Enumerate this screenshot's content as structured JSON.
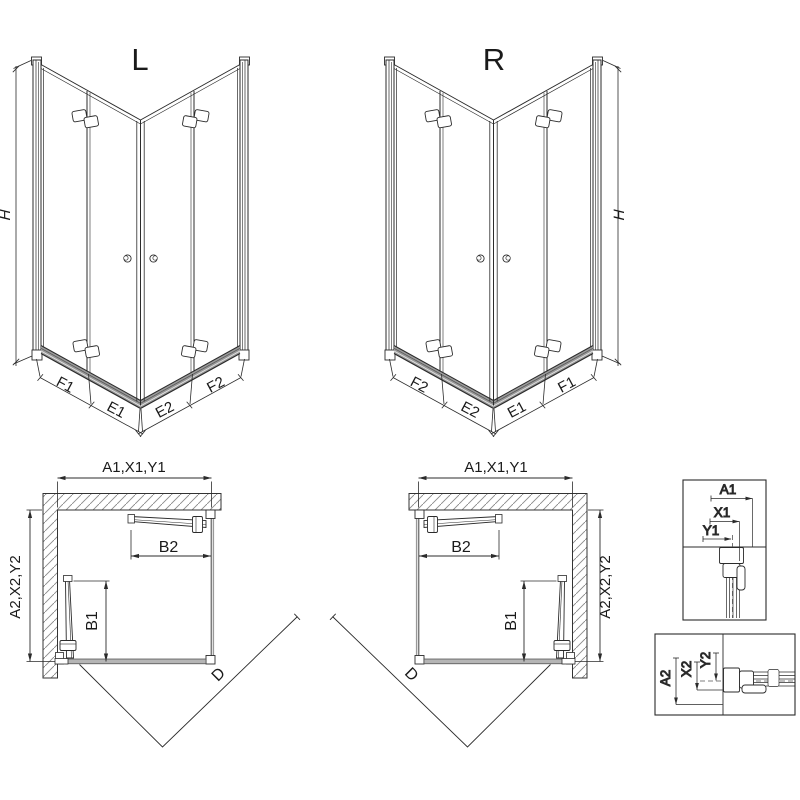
{
  "drawing": {
    "view_left": {
      "title": "L",
      "height_label": "H",
      "bottom_labels": [
        "F1",
        "E1",
        "E2",
        "F2"
      ]
    },
    "view_right": {
      "title": "R",
      "height_label": "H",
      "bottom_labels": [
        "F2",
        "E2",
        "E1",
        "F1"
      ]
    },
    "plan_left": {
      "width_label": "A1,X1,Y1",
      "depth_label": "A2,X2,Y2",
      "door_width_label": "B2",
      "door_depth_label": "B1",
      "diagonal_label": "D"
    },
    "plan_right": {
      "width_label": "A1,X1,Y1",
      "depth_label": "A2,X2,Y2",
      "door_width_label": "B2",
      "door_depth_label": "B1",
      "diagonal_label": "D"
    },
    "detail_top": {
      "labels": [
        "A1",
        "X1",
        "Y1"
      ]
    },
    "detail_bottom": {
      "labels": [
        "A2",
        "X2",
        "Y2"
      ]
    }
  },
  "colors": {
    "line": "#2b2b2b",
    "rail_fill": "#9a9a9a",
    "hatch": "#888888",
    "background": "#ffffff",
    "text": "#1a1a1a"
  }
}
